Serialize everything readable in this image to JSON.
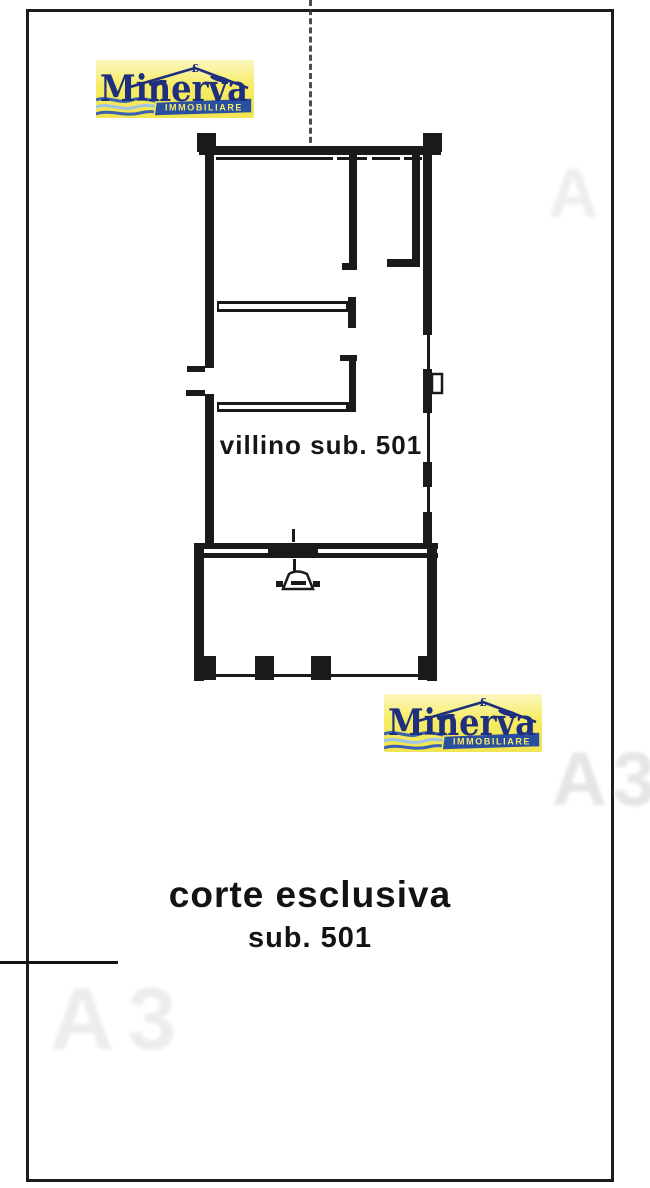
{
  "logo": {
    "brand": "Minerva",
    "subtitle": "IMMOBILIARE",
    "roof_symbol": "£",
    "colors": {
      "background_yellow": "#f6ec64",
      "background_pale": "#fcf7c0",
      "navy": "#1e2f7d",
      "ribbon_blue": "#2a4fa0",
      "ribbon_border_yellow": "#f2e552",
      "wave_blue": "#3a62ae",
      "wave_light_blue": "#9fc4e8"
    }
  },
  "plan": {
    "unit_label": "villino sub. 501",
    "court_label": "corte esclusiva",
    "court_sub_label": "sub. 501",
    "ink_color": "#1a1a1a"
  },
  "watermark": {
    "label_full": "A3",
    "label_partial": "A"
  }
}
